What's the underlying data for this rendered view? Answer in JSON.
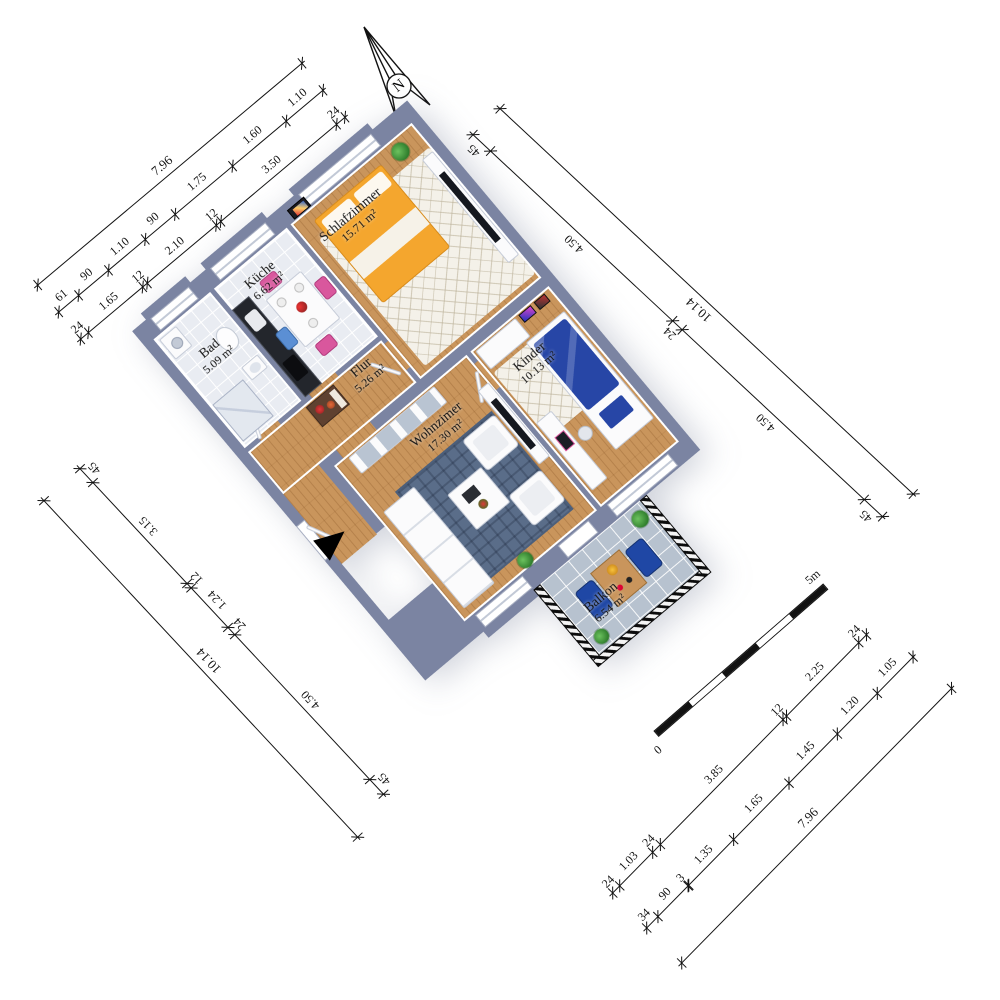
{
  "compass": {
    "label": "N"
  },
  "scale_bar": {
    "zero_label": "0",
    "end_label": "5m",
    "segments": 5
  },
  "rooms": [
    {
      "name": "Schlafzimmer",
      "area": "15.71 m²",
      "furniture": [
        "double-bed",
        "tv-sideboard",
        "tv",
        "potted-plant",
        "wall-picture",
        "rug"
      ]
    },
    {
      "name": "Küche",
      "area": "6.62 m²",
      "furniture": [
        "kitchen-counter",
        "cooktop",
        "dining-table",
        "pink-chairs",
        "blue-chair"
      ]
    },
    {
      "name": "Bad",
      "area": "5.09 m²",
      "furniture": [
        "shower",
        "toilet",
        "washbasin",
        "washing-machine"
      ]
    },
    {
      "name": "Flur",
      "area": "5.26 m²",
      "furniture": [
        "sideboard",
        "flowers"
      ]
    },
    {
      "name": "Wohnzimer",
      "area": "17.30 m²",
      "furniture": [
        "sofa",
        "armchair",
        "armchair",
        "coffee-table",
        "rug",
        "wall-unit",
        "tv-lowboard",
        "tv",
        "potted-plant"
      ]
    },
    {
      "name": "Kinder",
      "area": "10.13 m²",
      "furniture": [
        "bed",
        "desk",
        "desk-chair",
        "wardrobe",
        "posters",
        "rug"
      ]
    },
    {
      "name": "Balkon",
      "area": "6.54 m²",
      "furniture": [
        "garden-table",
        "armchair",
        "armchair",
        "potted-plants",
        "railing"
      ]
    }
  ],
  "dimensions": {
    "top_left": {
      "overall": [
        "7.96"
      ],
      "detail": [
        "61",
        "90",
        "1.10",
        "90",
        "1.75",
        "1.60",
        "1.10"
      ],
      "walls": [
        "24",
        "1.65",
        "12",
        "2.10",
        "12",
        "3.50",
        "24"
      ]
    },
    "right": {
      "overall": [
        "10.14"
      ],
      "detail": [
        "45",
        "4.50",
        "24",
        "4.50",
        "45"
      ]
    },
    "left": {
      "overall": [
        "10.14"
      ],
      "detail": [
        "45",
        "3.15",
        "12",
        "1.24",
        "24",
        "4.50",
        "45"
      ]
    },
    "bottom_right": {
      "overall": [
        "7.96"
      ],
      "detail": [
        "34",
        "90",
        "3",
        "1.35",
        "1.65",
        "1.45",
        "1.20",
        "1.05"
      ],
      "walls": [
        "24",
        "1.03",
        "24",
        "3.85",
        "12",
        "2.25",
        "24"
      ]
    }
  },
  "colors": {
    "wall": "#7b84a2",
    "wood_floor": "#c9955c",
    "tile_floor": "#e9ecf2",
    "balcony_floor": "#b7c2cf",
    "rug_blue": "#5a6d89",
    "bed_orange": "#f4a62e",
    "kids_bed_blue": "#2746a6",
    "accent_pink": "#d9579d",
    "accent_blue": "#5b8fd4",
    "balcony_chair_blue": "#1f47a5",
    "plant_green": "#3b9440"
  }
}
